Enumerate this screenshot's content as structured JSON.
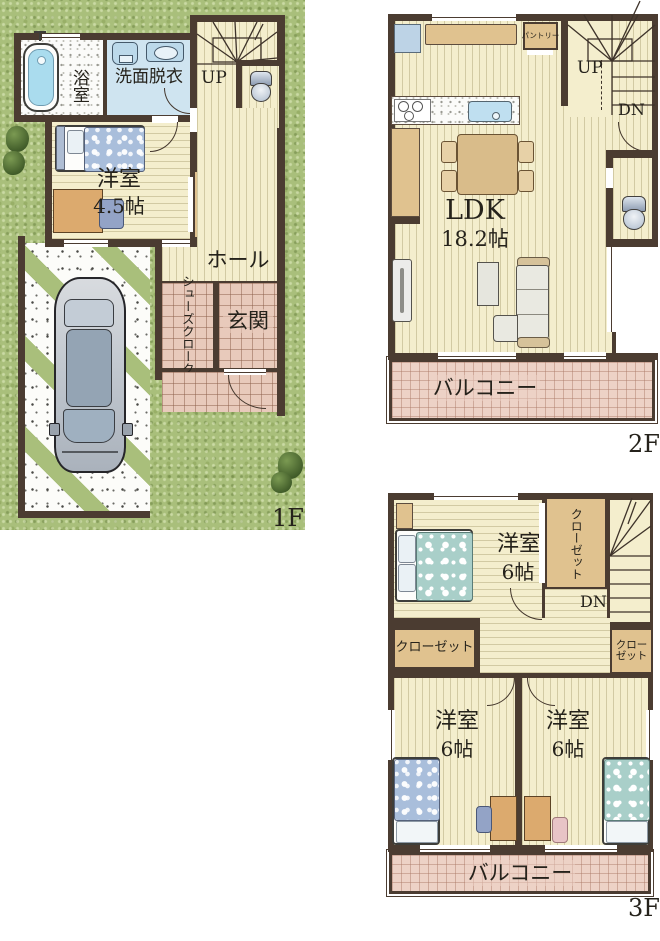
{
  "f1": {
    "floor_label": "1F",
    "bath": "浴室",
    "washroom": "洗面脱衣",
    "up": "UP",
    "bedroom": "洋室",
    "bedroom_size": "4.5帖",
    "closet": "クローゼット",
    "hall": "ホール",
    "shoe_closet": "シューズクローク",
    "entrance": "玄関"
  },
  "f2": {
    "floor_label": "2F",
    "pantry": "パントリー",
    "up": "UP",
    "down": "DN",
    "ldk": "LDK",
    "ldk_size": "18.2帖",
    "balcony": "バルコニー"
  },
  "f3": {
    "floor_label": "3F",
    "bedroom_main": "洋室",
    "bedroom_main_size": "6帖",
    "closet_main": "クローゼット",
    "down": "DN",
    "closet_left": "クローゼット",
    "closet_right": "クローゼット",
    "bedroom_left": "洋室",
    "bedroom_left_size": "6帖",
    "bedroom_right": "洋室",
    "bedroom_right_size": "6帖",
    "balcony": "バルコニー"
  },
  "colors": {
    "wall": "#4b3c31",
    "floor": "#f4eecd",
    "grass": "#a9bf7b",
    "closet_tan": "#e0c28f",
    "tile_pink": "#edd2c6",
    "washroom_blue": "#cfe4f0",
    "water_blue": "#aadcee"
  }
}
